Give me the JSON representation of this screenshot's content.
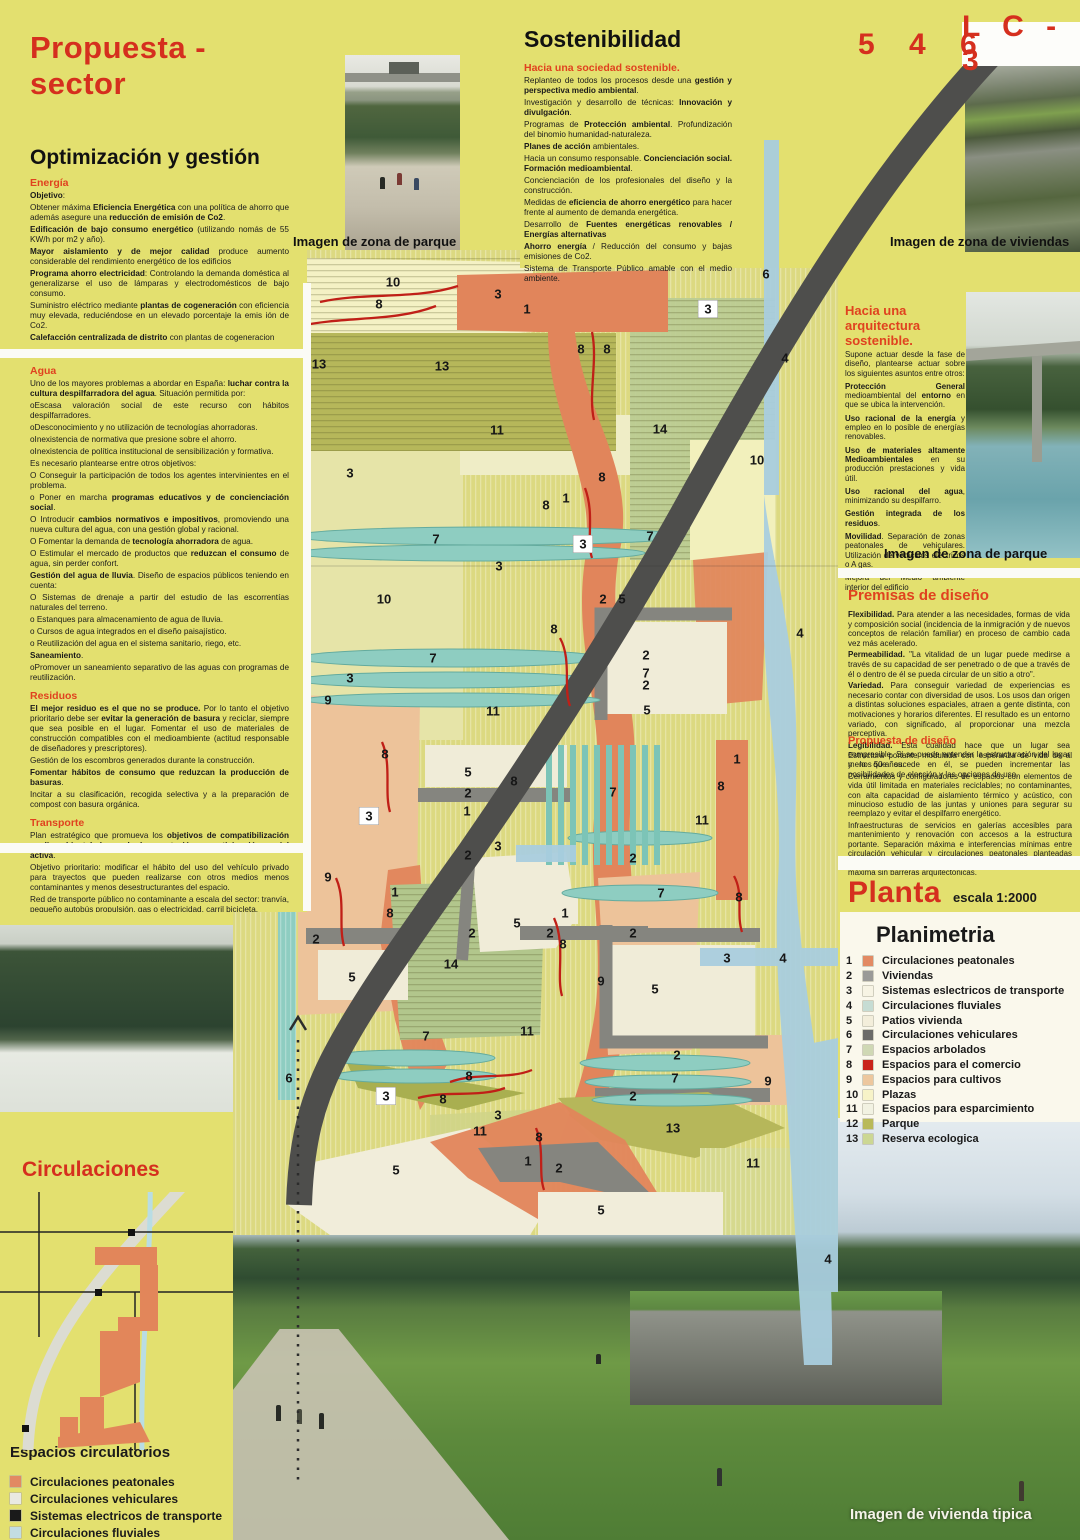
{
  "header": {
    "title": "Propuesta - sector",
    "code_left": "5 4 6",
    "code_right": "L C - 3"
  },
  "left_panel": {
    "title": "Optimización y gestión",
    "energia": {
      "heading": "Energía",
      "paragraphs": [
        "**Objetivo**:",
        "Obtener máxima **Eficiencia Energética** con una política de ahorro que además asegure una **reducción de emisión de Co2**.",
        "**Edificación de bajo consumo energético** (utilizando nomás de 55 KW/h por m2 y año).",
        "**Mayor aislamiento y de mejor calidad** produce aumento considerable del rendimiento energético de los edificios",
        "**Programa ahorro electricidad**: Controlando la demanda doméstica al generalizarse el uso de lámparas y electrodomésticos de bajo consumo.",
        "Suministro eléctrico mediante **plantas de cogeneración** con eficiencia muy elevada, reduciéndose en un elevado porcentaje la emis ión de Co2.",
        "**Calefacción centralizada de distrito** con plantas de cogeneracion"
      ]
    },
    "agua": {
      "heading": "Agua",
      "paragraphs": [
        "Uno de los mayores problemas a abordar en España: **luchar contra la cultura despilfarradora del agua**. Situación permitida por:",
        "oEscasa valoración social de este recurso con hábitos despilfarradores.",
        "oDesconocimiento y no utilización de tecnologías ahorradoras.",
        "oInexistencia de normativa que presione sobre el ahorro.",
        "oInexistencia de política institucional de sensibilización y formativa.",
        "Es necesario plantearse entre otros objetivos:",
        "O Conseguir la participación de todos los agentes intervinientes en el problema.",
        "o Poner en marcha **programas educativos y de concienciación social**.",
        "O Introducir **cambios normativos e impositivos**, promoviendo una nueva cultura del agua, con una gestión global y racional.",
        "O Fomentar la demanda de **tecnología ahorradora** de agua.",
        "O Estimular el mercado de productos que **reduzcan el consumo** de agua, sin perder confort.",
        "**Gestión del agua de lluvia**. Diseño de espacios públicos teniendo en cuenta:",
        "O Sistemas de drenaje a partir del estudio de las escorrentías naturales del terreno.",
        "o Estanques para almacenamiento de agua de lluvia.",
        "o Cursos de agua integrados en el diseño paisajístico.",
        "o Reutilización del agua en el sistema sanitario, riego, etc.",
        "**Saneamiento**.",
        "oPromover un saneamiento separativo de las aguas con programas de reutilización."
      ]
    },
    "residuos": {
      "heading": "Residuos",
      "paragraphs": [
        "**El mejor residuo es el que no se produce.** Por lo tanto el objetivo prioritario debe ser **evitar la generación de basura** y reciclar, siempre que sea posible en el lugar. Fomentar el uso de materiales de construcción compatibles con el medioambiente (actitud responsable de diseñadores y prescriptores).",
        "Gestión de los escombros generados durante la construcción.",
        "**Fomentar hábitos de consumo que reduzcan la producción de basuras**.",
        "Incitar a su clasificación, recogida selectiva y a la preparación de compost con basura orgánica."
      ]
    },
    "transporte": {
      "heading": "Transporte",
      "paragraphs": [
        "Plan estratégico que promueva los **objetivos de compatibilización medioambiental, logrando la aceptación y participación social activa**.",
        "Objetivo prioritario: modificar el hábito del uso del vehículo privado para trayectos que pueden realizarse con otros medios menos contaminantes y menos desestructurantes del espacio.",
        "Red de transporte público no contaminante a escala del sector: tranvía, pequeño autobús propulsión, gas o electricidad, carril bicicleta.",
        "Rotunda separación de circulación vehicular privada y peatonal estudiando medios de acceso a las viviendas para aprovisionamiento, por ejemplo."
      ]
    }
  },
  "sustainability": {
    "title": "Sostenibilidad",
    "subheading": "Hacia una sociedad sostenible.",
    "paragraphs": [
      "Replanteo de todos los procesos desde una **gestión y perspectiva medio ambiental**.",
      "Investigación y desarrollo de técnicas: **Innovación y divulgación**.",
      "Programas de **Protección ambiental**. Profundización del binomio humanidad-naturaleza.",
      "**Planes de acción** ambientales.",
      "Hacia un consumo responsable. **Concienciación social. Formación medioambiental**.",
      "Concienciación de los profesionales del diseño y la construcción.",
      "Medidas de **eficiencia de ahorro energético** para hacer frente al aumento de demanda energética.",
      "Desarrollo de **Fuentes energéticas renovables / Energías alternativas**",
      "**Ahorro energía** / Reducción del consumo y bajas emisiones de Co2.",
      "Sistema de Transporte Público amable con el medio ambiente."
    ]
  },
  "architecture": {
    "heading": "Hacia una arquitectura sostenible.",
    "paragraphs": [
      "Supone actuar desde la fase de diseño, plantearse actuar sobre los siguientes asuntos entre otros:",
      "**Protección General** medioambiental del **entorno** en que se ubica la intervención.",
      "**Uso racional de la energía** y empleo en lo posible de energías renovables.",
      "**Uso de materiales altamente Medioambientales** en su producción prestaciones y vida útil.",
      "**Uso racional del agua**, minimizando su despilfarro.",
      "**Gestión integrada de los residuos**.",
      "**Movilidad**. Separación de zonas peatonales de vehiculares. Utilización de vehículos eléctricos o A gas.",
      "Mejora del Medio ambiente interior del edificio"
    ]
  },
  "premises": {
    "heading": "Premisas de diseño",
    "paragraphs": [
      "**Flexibilidad.** Para atender a las necesidades, formas de vida y composición social (incidencia de la inmigración y de nuevos conceptos de relación familiar) en proceso de cambio cada vez más acelerado.",
      "**Permeabilidad.** \"La vitalidad de un lugar puede medirse a través de su capacidad de ser penetrado o de que a través de él o dentro de él se pueda circular de un sitio a otro\".",
      "**Variedad.** Para conseguir variedad de experiencias es necesario contar con diversidad de usos. Los usos dan origen a distintas soluciones espaciales, atraen a gente distinta, con motivaciones y horarios diferentes. El resultado es un entorno variado, con significado, al proporcionar una mezcla perceptiva.",
      "**Legibilidad.** Esta cualidad hace que un lugar sea compresible. Si se puede entender la estructuración del lugar y lo que sucede en él, se pueden incrementar las posibilidades de elección y las opciones de uso."
    ]
  },
  "design_proposal": {
    "heading": "Propuesta de diseño",
    "paragraphs": [
      "Estructura portante modulada con esperanza de vida de al menos 50 años.",
      "Cerramientos y configuradores de espacios con elementos de vida útil limitada en materiales reciclables; no contaminantes, con alta capacidad de aislamiento térmico y acústico, con minucioso estudio de las juntas y uniones para segurar su reemplazo y evitar el despilfarro energético.",
      "Infraestructuras de servicios en galerías accesibles para mantenimiento y renovación con accesos a la estructura portante.  Separación máxima e interferencias mínimas entre circulación vehicular y circulaciones peatonales planteadas como red de conexión entre espacios donde la accesibilidad es máxima sin barreras arquitectónicas."
    ]
  },
  "planta": {
    "title": "Planta",
    "scale": "escala 1:2000"
  },
  "planimetria": {
    "title": "Planimetria",
    "items": [
      {
        "num": "1",
        "color": "#e28a63",
        "label": "Circulaciones peatonales"
      },
      {
        "num": "2",
        "color": "#9a9a98",
        "label": "Viviendas"
      },
      {
        "num": "3",
        "color": "#f7f4e4",
        "label": "Sistemas eslectricos de transporte"
      },
      {
        "num": "4",
        "color": "#c6dcd3",
        "label": "Circulaciones fluviales"
      },
      {
        "num": "5",
        "color": "#f3eedb",
        "label": "Patios vivienda"
      },
      {
        "num": "6",
        "color": "#6b6b69",
        "label": "Circulaciones vehiculares"
      },
      {
        "num": "7",
        "color": "#cfd8b4",
        "label": "Espacios arbolados"
      },
      {
        "num": "8",
        "color": "#c9241c",
        "label": "Espacios para el comercio"
      },
      {
        "num": "9",
        "color": "#edc79e",
        "label": "Espacios para cultivos"
      },
      {
        "num": "10",
        "color": "#f7f3c8",
        "label": "Plazas"
      },
      {
        "num": "11",
        "color": "#f2f2e2",
        "label": "Espacios para esparcimiento"
      },
      {
        "num": "12",
        "color": "#b9b959",
        "label": "Parque"
      },
      {
        "num": "13",
        "color": "#ccd793",
        "label": "Reserva ecologica"
      }
    ]
  },
  "circulaciones": {
    "title": "Circulaciones",
    "legend_title": "Espacios circulatorios",
    "items": [
      {
        "color": "#e28a63",
        "label": "Circulaciones peatonales"
      },
      {
        "color": "#e9e9e1",
        "label": "Circulaciones vehiculares"
      },
      {
        "color": "#1a1a1a",
        "label": "Sistemas electricos de transporte"
      },
      {
        "color": "#c3dde3",
        "label": "Circulaciones fluviales"
      }
    ]
  },
  "captions": {
    "park_top": "Imagen de zona de parque",
    "viviendas": "Imagen de zona de viviendas",
    "park_right": "Imagen de zona de parque",
    "vivienda_tipica": "Imagen de vivienda tipica"
  },
  "colors": {
    "accent_red": "#d52f1e",
    "poster_yellow": "#e3e06f",
    "road_gray": "#4e4e4c",
    "river_blue": "#a9cede"
  },
  "map_labels": [
    {
      "n": "10",
      "x": 393,
      "y": 282
    },
    {
      "n": "8",
      "x": 379,
      "y": 304
    },
    {
      "n": "3",
      "x": 498,
      "y": 294
    },
    {
      "n": "1",
      "x": 527,
      "y": 309
    },
    {
      "n": "8",
      "x": 581,
      "y": 349
    },
    {
      "n": "8",
      "x": 607,
      "y": 349
    },
    {
      "n": "3",
      "x": 708,
      "y": 309,
      "boxed": true
    },
    {
      "n": "6",
      "x": 766,
      "y": 274
    },
    {
      "n": "13",
      "x": 319,
      "y": 364
    },
    {
      "n": "13",
      "x": 442,
      "y": 366
    },
    {
      "n": "4",
      "x": 785,
      "y": 358
    },
    {
      "n": "7",
      "x": 286,
      "y": 368
    },
    {
      "n": "11",
      "x": 497,
      "y": 430
    },
    {
      "n": "14",
      "x": 660,
      "y": 429
    },
    {
      "n": "10",
      "x": 757,
      "y": 460
    },
    {
      "n": "3",
      "x": 350,
      "y": 473
    },
    {
      "n": "8",
      "x": 602,
      "y": 477
    },
    {
      "n": "1",
      "x": 566,
      "y": 498
    },
    {
      "n": "8",
      "x": 546,
      "y": 505
    },
    {
      "n": "7",
      "x": 286,
      "y": 544
    },
    {
      "n": "7",
      "x": 436,
      "y": 539
    },
    {
      "n": "7",
      "x": 650,
      "y": 536
    },
    {
      "n": "3",
      "x": 583,
      "y": 544,
      "boxed": true
    },
    {
      "n": "3",
      "x": 499,
      "y": 566
    },
    {
      "n": "10",
      "x": 384,
      "y": 599
    },
    {
      "n": "2",
      "x": 603,
      "y": 599
    },
    {
      "n": "5",
      "x": 622,
      "y": 599
    },
    {
      "n": "8",
      "x": 554,
      "y": 629
    },
    {
      "n": "4",
      "x": 800,
      "y": 633
    },
    {
      "n": "7",
      "x": 433,
      "y": 658
    },
    {
      "n": "2",
      "x": 646,
      "y": 655
    },
    {
      "n": "3",
      "x": 350,
      "y": 678
    },
    {
      "n": "7",
      "x": 646,
      "y": 673
    },
    {
      "n": "2",
      "x": 646,
      "y": 685
    },
    {
      "n": "9",
      "x": 328,
      "y": 700
    },
    {
      "n": "5",
      "x": 647,
      "y": 710
    },
    {
      "n": "11",
      "x": 493,
      "y": 711
    },
    {
      "n": "8",
      "x": 385,
      "y": 754
    },
    {
      "n": "1",
      "x": 737,
      "y": 759
    },
    {
      "n": "5",
      "x": 468,
      "y": 772
    },
    {
      "n": "8",
      "x": 514,
      "y": 781
    },
    {
      "n": "8",
      "x": 721,
      "y": 786
    },
    {
      "n": "7",
      "x": 613,
      "y": 792
    },
    {
      "n": "2",
      "x": 468,
      "y": 793
    },
    {
      "n": "1",
      "x": 467,
      "y": 811
    },
    {
      "n": "3",
      "x": 369,
      "y": 816,
      "boxed": true
    },
    {
      "n": "11",
      "x": 702,
      "y": 820
    },
    {
      "n": "3",
      "x": 498,
      "y": 846
    },
    {
      "n": "2",
      "x": 468,
      "y": 855
    },
    {
      "n": "2",
      "x": 633,
      "y": 858
    },
    {
      "n": "9",
      "x": 328,
      "y": 877
    },
    {
      "n": "1",
      "x": 395,
      "y": 892
    },
    {
      "n": "7",
      "x": 661,
      "y": 893
    },
    {
      "n": "8",
      "x": 739,
      "y": 897
    },
    {
      "n": "8",
      "x": 390,
      "y": 913
    },
    {
      "n": "1",
      "x": 565,
      "y": 913
    },
    {
      "n": "5",
      "x": 517,
      "y": 923
    },
    {
      "n": "2",
      "x": 472,
      "y": 933
    },
    {
      "n": "2",
      "x": 550,
      "y": 933
    },
    {
      "n": "2",
      "x": 633,
      "y": 933
    },
    {
      "n": "2",
      "x": 316,
      "y": 939
    },
    {
      "n": "8",
      "x": 563,
      "y": 944
    },
    {
      "n": "3",
      "x": 727,
      "y": 958
    },
    {
      "n": "4",
      "x": 783,
      "y": 958
    },
    {
      "n": "14",
      "x": 451,
      "y": 964
    },
    {
      "n": "5",
      "x": 352,
      "y": 977
    },
    {
      "n": "9",
      "x": 601,
      "y": 981
    },
    {
      "n": "5",
      "x": 655,
      "y": 989
    },
    {
      "n": "11",
      "x": 527,
      "y": 1031
    },
    {
      "n": "7",
      "x": 426,
      "y": 1036
    },
    {
      "n": "2",
      "x": 677,
      "y": 1055
    },
    {
      "n": "8",
      "x": 469,
      "y": 1076
    },
    {
      "n": "6",
      "x": 289,
      "y": 1078
    },
    {
      "n": "7",
      "x": 675,
      "y": 1078
    },
    {
      "n": "9",
      "x": 768,
      "y": 1081
    },
    {
      "n": "3",
      "x": 386,
      "y": 1096,
      "boxed": true
    },
    {
      "n": "8",
      "x": 443,
      "y": 1099
    },
    {
      "n": "2",
      "x": 633,
      "y": 1096
    },
    {
      "n": "3",
      "x": 498,
      "y": 1115
    },
    {
      "n": "11",
      "x": 480,
      "y": 1131
    },
    {
      "n": "13",
      "x": 673,
      "y": 1128
    },
    {
      "n": "8",
      "x": 539,
      "y": 1137
    },
    {
      "n": "1",
      "x": 528,
      "y": 1161
    },
    {
      "n": "11",
      "x": 753,
      "y": 1163
    },
    {
      "n": "2",
      "x": 559,
      "y": 1168
    },
    {
      "n": "5",
      "x": 396,
      "y": 1170
    },
    {
      "n": "5",
      "x": 601,
      "y": 1210
    },
    {
      "n": "4",
      "x": 828,
      "y": 1259
    }
  ]
}
